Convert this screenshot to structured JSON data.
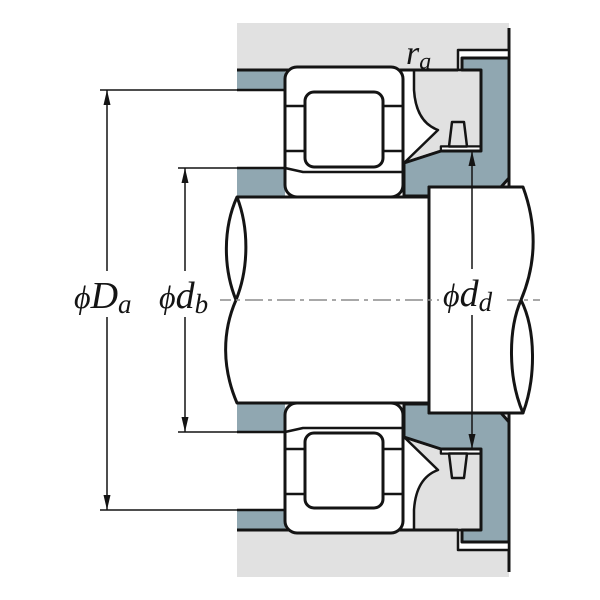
{
  "diagram": {
    "labels": {
      "Da": {
        "phi": "ϕ",
        "main": "D",
        "sub": "a"
      },
      "db": {
        "phi": "ϕ",
        "main": "d",
        "sub": "b"
      },
      "dd": {
        "phi": "ϕ",
        "main": "d",
        "sub": "d"
      },
      "ra": {
        "main": "r",
        "sub": "a"
      }
    },
    "colors": {
      "housing": "#e1e1e1",
      "abutment": "#90a7b1",
      "line": "#141414",
      "centerline": "#8c8c8c",
      "background": "#ffffff"
    }
  }
}
